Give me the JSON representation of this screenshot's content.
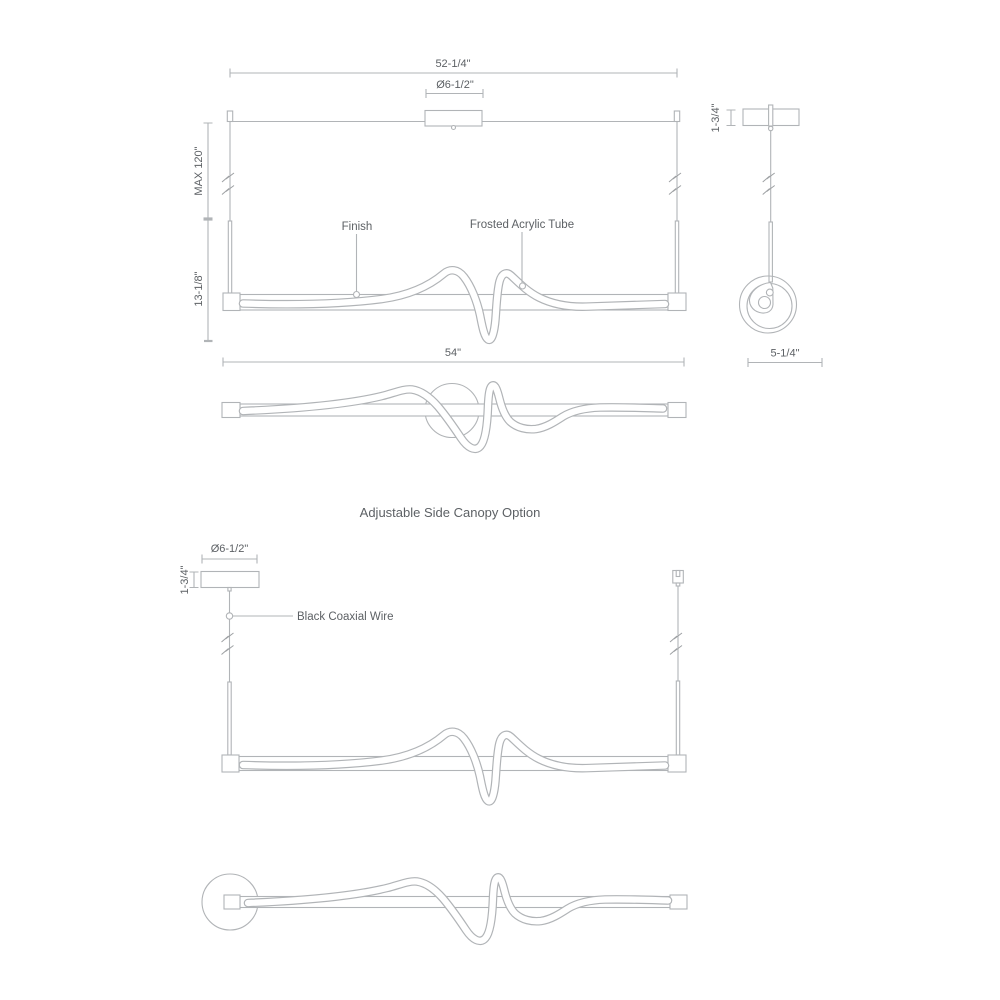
{
  "colors": {
    "background": "#ffffff",
    "line": "#b1b4b7",
    "text": "#5d6165"
  },
  "main_drawing": {
    "front": {
      "dim_overall_top": "52-1/4\"",
      "dim_canopy_diameter": "Ø6-1/2\"",
      "dim_max_suspension": "MAX 120\"",
      "dim_fixture_height": "13-1/8\"",
      "dim_overall_bottom": "54\"",
      "finish_label": "Finish",
      "tube_label": "Frosted Acrylic Tube"
    },
    "side": {
      "dim_canopy_height": "1-3/4\"",
      "dim_fixture_depth": "5-1/4\""
    }
  },
  "canopy_option_drawing": {
    "title": "Adjustable Side Canopy Option",
    "front": {
      "dim_canopy_diameter": "Ø6-1/2\"",
      "dim_canopy_height": "1-3/4\"",
      "wire_label": "Black Coaxial Wire"
    }
  }
}
